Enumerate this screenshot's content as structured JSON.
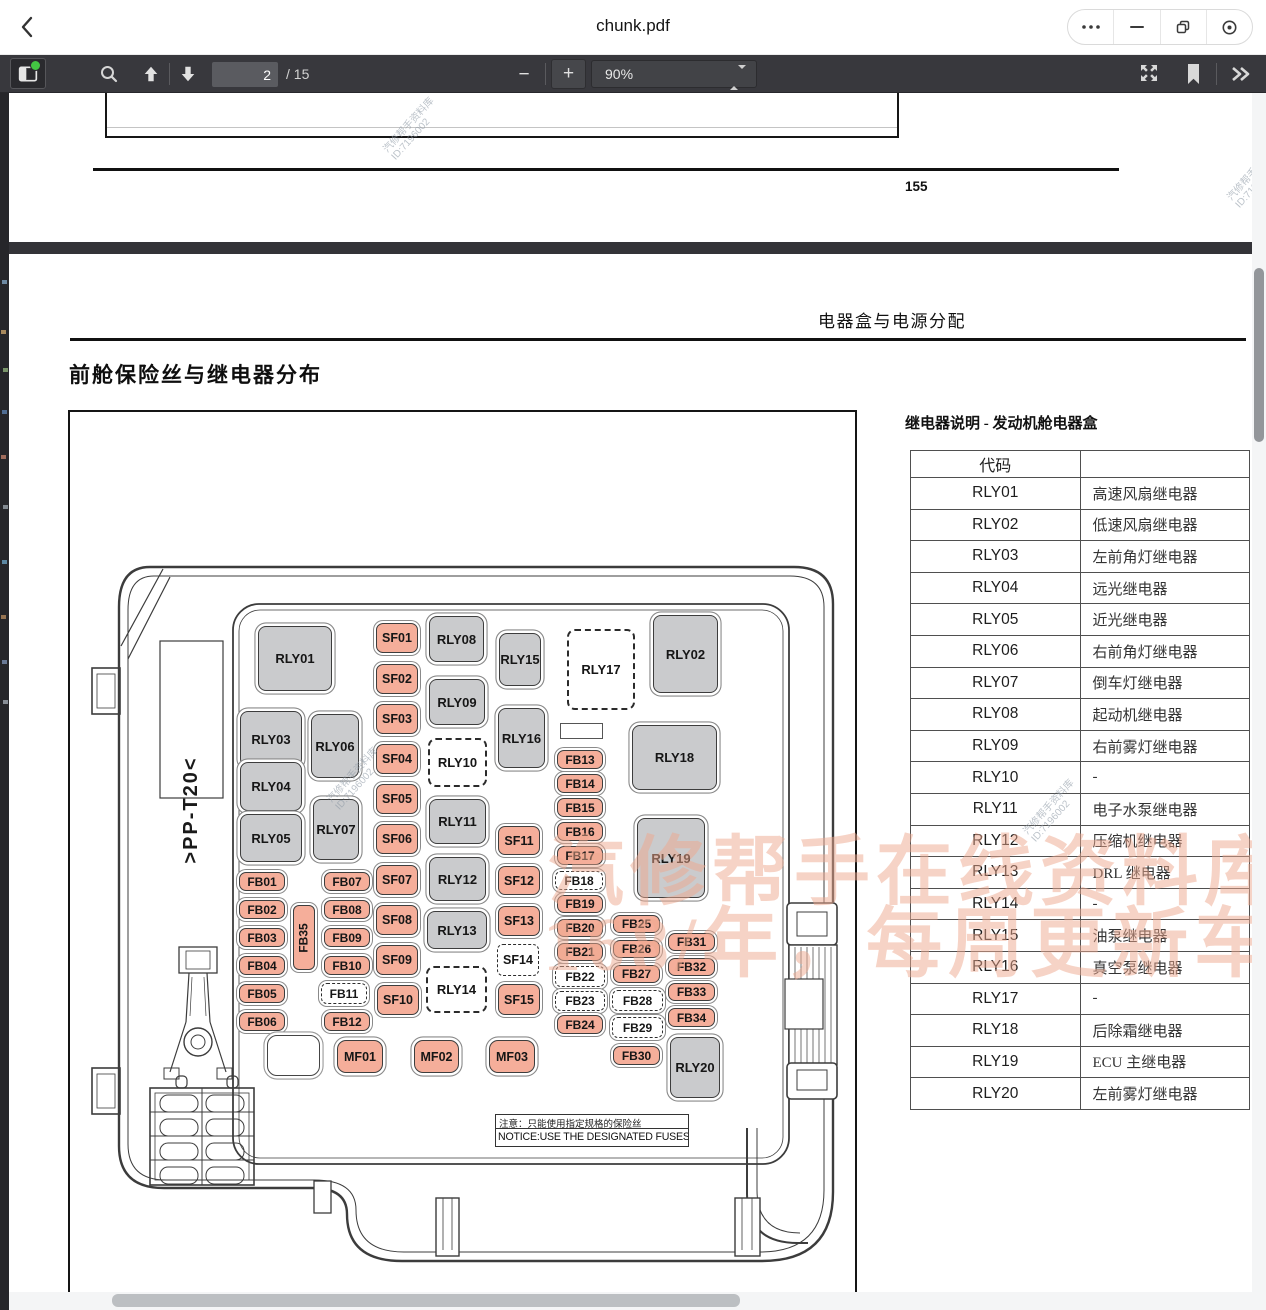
{
  "titlebar": {
    "title": "chunk.pdf",
    "icons": [
      "back-chevron",
      "more-dots",
      "minimize",
      "restore",
      "focus-circle"
    ]
  },
  "toolbar": {
    "page_value": "2",
    "page_total": "/ 15",
    "zoom_value": "90%",
    "icons": [
      "sidebar-toggle",
      "search",
      "page-up",
      "page-down",
      "zoom-out",
      "zoom-in",
      "presentation",
      "bookmark",
      "more-chevrons"
    ]
  },
  "page1": {
    "page_number": "155"
  },
  "page2": {
    "corner_header": "电器盒与电源分配",
    "section_title": "前舱保险丝与继电器分布",
    "side_label": ">PP-T20<",
    "notice_cn": "注意：只能使用指定规格的保险丝",
    "notice_en": "NOTICE:USE THE DESIGNATED FUSES ONLY!"
  },
  "watermarks": {
    "stamp_line1": "汽修帮手资料库",
    "stamp_line2": "ID:7196002",
    "banner_line1": "汽修帮手在线资料库",
    "banner_line2": "168/年，每周更新车",
    "banner_color": "#efa98f"
  },
  "relay_table": {
    "title": "继电器说明 - 发动机舱电器盒",
    "col1_header": "代码",
    "col2_header": "",
    "rows": [
      {
        "code": "RLY01",
        "desc": "高速风扇继电器"
      },
      {
        "code": "RLY02",
        "desc": "低速风扇继电器"
      },
      {
        "code": "RLY03",
        "desc": "左前角灯继电器"
      },
      {
        "code": "RLY04",
        "desc": "远光继电器"
      },
      {
        "code": "RLY05",
        "desc": "近光继电器"
      },
      {
        "code": "RLY06",
        "desc": "右前角灯继电器"
      },
      {
        "code": "RLY07",
        "desc": "倒车灯继电器"
      },
      {
        "code": "RLY08",
        "desc": "起动机继电器"
      },
      {
        "code": "RLY09",
        "desc": "右前雾灯继电器"
      },
      {
        "code": "RLY10",
        "desc": "-"
      },
      {
        "code": "RLY11",
        "desc": "电子水泵继电器"
      },
      {
        "code": "RLY12",
        "desc": "压缩机继电器"
      },
      {
        "code": "RLY13",
        "desc": "DRL 继电器"
      },
      {
        "code": "RLY14",
        "desc": "-"
      },
      {
        "code": "RLY15",
        "desc": "油泵继电器"
      },
      {
        "code": "RLY16",
        "desc": "真空泵继电器"
      },
      {
        "code": "RLY17",
        "desc": "-"
      },
      {
        "code": "RLY18",
        "desc": "后除霜继电器"
      },
      {
        "code": "RLY19",
        "desc": "ECU 主继电器"
      },
      {
        "code": "RLY20",
        "desc": "左前雾灯继电器"
      }
    ]
  },
  "diagram": {
    "colors": {
      "relay_fill": "#cacbcd",
      "fuse_fill": "#f5ae9a",
      "outline": "#3d3d3d"
    },
    "nodes": [
      {
        "id": "RLY01",
        "x": 258,
        "y": 626,
        "w": 74,
        "h": 65,
        "t": "relay"
      },
      {
        "id": "RLY02",
        "x": 653,
        "y": 615,
        "w": 65,
        "h": 78,
        "t": "relay"
      },
      {
        "id": "RLY03",
        "x": 240,
        "y": 711,
        "w": 62,
        "h": 56,
        "t": "relay"
      },
      {
        "id": "RLY04",
        "x": 240,
        "y": 762,
        "w": 62,
        "h": 49,
        "t": "relay"
      },
      {
        "id": "RLY05",
        "x": 240,
        "y": 814,
        "w": 62,
        "h": 48,
        "t": "relay"
      },
      {
        "id": "RLY06",
        "x": 311,
        "y": 714,
        "w": 48,
        "h": 64,
        "t": "relay"
      },
      {
        "id": "RLY07",
        "x": 313,
        "y": 799,
        "w": 46,
        "h": 61,
        "t": "relay"
      },
      {
        "id": "RLY08",
        "x": 429,
        "y": 616,
        "w": 55,
        "h": 46,
        "t": "relay"
      },
      {
        "id": "RLY09",
        "x": 429,
        "y": 679,
        "w": 56,
        "h": 46,
        "t": "relay"
      },
      {
        "id": "RLY11",
        "x": 429,
        "y": 799,
        "w": 57,
        "h": 45,
        "t": "relay"
      },
      {
        "id": "RLY12",
        "x": 429,
        "y": 857,
        "w": 57,
        "h": 44,
        "t": "relay"
      },
      {
        "id": "RLY13",
        "x": 427,
        "y": 911,
        "w": 60,
        "h": 38,
        "t": "relay"
      },
      {
        "id": "RLY15",
        "x": 499,
        "y": 633,
        "w": 42,
        "h": 53,
        "t": "relay"
      },
      {
        "id": "RLY16",
        "x": 498,
        "y": 708,
        "w": 47,
        "h": 60,
        "t": "relay"
      },
      {
        "id": "RLY18",
        "x": 632,
        "y": 725,
        "w": 85,
        "h": 65,
        "t": "relay"
      },
      {
        "id": "RLY19",
        "x": 637,
        "y": 818,
        "w": 68,
        "h": 80,
        "t": "relay"
      },
      {
        "id": "RLY20",
        "x": 670,
        "y": 1037,
        "w": 50,
        "h": 61,
        "t": "relay"
      },
      {
        "id": "RLY10",
        "x": 428,
        "y": 738,
        "w": 59,
        "h": 49,
        "t": "dash-lg"
      },
      {
        "id": "RLY14",
        "x": 426,
        "y": 966,
        "w": 61,
        "h": 47,
        "t": "dash-lg"
      },
      {
        "id": "RLY17",
        "x": 567,
        "y": 629,
        "w": 68,
        "h": 81,
        "t": "dash-lg"
      },
      {
        "id": "SF14",
        "x": 497,
        "y": 944,
        "w": 42,
        "h": 32,
        "t": "dash-sf"
      },
      {
        "id": "FB11",
        "x": 321,
        "y": 983,
        "w": 46,
        "h": 21,
        "t": "dash-fb"
      },
      {
        "id": "FB18",
        "x": 555,
        "y": 871,
        "w": 48,
        "h": 19,
        "t": "dash-fb"
      },
      {
        "id": "FB22",
        "x": 555,
        "y": 966,
        "w": 50,
        "h": 21,
        "t": "dash-fb"
      },
      {
        "id": "FB23",
        "x": 555,
        "y": 991,
        "w": 50,
        "h": 20,
        "t": "dash-fb"
      },
      {
        "id": "FB28",
        "x": 612,
        "y": 990,
        "w": 51,
        "h": 21,
        "t": "dash-fb"
      },
      {
        "id": "FB29",
        "x": 612,
        "y": 1017,
        "w": 51,
        "h": 21,
        "t": "dash-fb"
      },
      {
        "id": "SF01",
        "x": 376,
        "y": 623,
        "w": 42,
        "h": 30,
        "t": "fuse sf"
      },
      {
        "id": "SF02",
        "x": 376,
        "y": 664,
        "w": 42,
        "h": 30,
        "t": "fuse sf"
      },
      {
        "id": "SF03",
        "x": 376,
        "y": 704,
        "w": 42,
        "h": 30,
        "t": "fuse sf"
      },
      {
        "id": "SF04",
        "x": 376,
        "y": 744,
        "w": 42,
        "h": 30,
        "t": "fuse sf"
      },
      {
        "id": "SF05",
        "x": 376,
        "y": 784,
        "w": 42,
        "h": 30,
        "t": "fuse sf"
      },
      {
        "id": "SF06",
        "x": 376,
        "y": 824,
        "w": 42,
        "h": 30,
        "t": "fuse sf"
      },
      {
        "id": "SF07",
        "x": 376,
        "y": 865,
        "w": 42,
        "h": 30,
        "t": "fuse sf"
      },
      {
        "id": "SF08",
        "x": 376,
        "y": 905,
        "w": 42,
        "h": 30,
        "t": "fuse sf"
      },
      {
        "id": "SF09",
        "x": 376,
        "y": 945,
        "w": 42,
        "h": 30,
        "t": "fuse sf"
      },
      {
        "id": "SF10",
        "x": 377,
        "y": 985,
        "w": 42,
        "h": 30,
        "t": "fuse sf"
      },
      {
        "id": "SF11",
        "x": 498,
        "y": 826,
        "w": 42,
        "h": 29,
        "t": "fuse sf"
      },
      {
        "id": "SF12",
        "x": 498,
        "y": 866,
        "w": 42,
        "h": 29,
        "t": "fuse sf"
      },
      {
        "id": "SF13",
        "x": 498,
        "y": 906,
        "w": 42,
        "h": 30,
        "t": "fuse sf"
      },
      {
        "id": "SF15",
        "x": 498,
        "y": 984,
        "w": 42,
        "h": 31,
        "t": "fuse sf"
      },
      {
        "id": "FB01",
        "x": 239,
        "y": 872,
        "w": 46,
        "h": 19,
        "t": "fuse"
      },
      {
        "id": "FB02",
        "x": 239,
        "y": 900,
        "w": 46,
        "h": 19,
        "t": "fuse"
      },
      {
        "id": "FB03",
        "x": 239,
        "y": 928,
        "w": 46,
        "h": 19,
        "t": "fuse"
      },
      {
        "id": "FB04",
        "x": 239,
        "y": 956,
        "w": 46,
        "h": 19,
        "t": "fuse"
      },
      {
        "id": "FB05",
        "x": 239,
        "y": 984,
        "w": 46,
        "h": 19,
        "t": "fuse"
      },
      {
        "id": "FB06",
        "x": 239,
        "y": 1012,
        "w": 46,
        "h": 19,
        "t": "fuse"
      },
      {
        "id": "FB07",
        "x": 324,
        "y": 872,
        "w": 46,
        "h": 19,
        "t": "fuse"
      },
      {
        "id": "FB08",
        "x": 324,
        "y": 900,
        "w": 46,
        "h": 19,
        "t": "fuse"
      },
      {
        "id": "FB09",
        "x": 324,
        "y": 928,
        "w": 46,
        "h": 19,
        "t": "fuse"
      },
      {
        "id": "FB10",
        "x": 324,
        "y": 956,
        "w": 46,
        "h": 19,
        "t": "fuse"
      },
      {
        "id": "FB12",
        "x": 324,
        "y": 1012,
        "w": 46,
        "h": 19,
        "t": "fuse"
      },
      {
        "id": "FB35",
        "x": 293,
        "y": 905,
        "w": 22,
        "h": 65,
        "t": "fusev"
      },
      {
        "id": "FB13",
        "x": 557,
        "y": 750,
        "w": 46,
        "h": 19,
        "t": "fuse"
      },
      {
        "id": "FB14",
        "x": 557,
        "y": 774,
        "w": 46,
        "h": 19,
        "t": "fuse"
      },
      {
        "id": "FB15",
        "x": 557,
        "y": 798,
        "w": 46,
        "h": 19,
        "t": "fuse"
      },
      {
        "id": "FB16",
        "x": 557,
        "y": 822,
        "w": 46,
        "h": 19,
        "t": "fuse"
      },
      {
        "id": "FB17",
        "x": 557,
        "y": 846,
        "w": 46,
        "h": 19,
        "t": "fuse"
      },
      {
        "id": "FB19",
        "x": 557,
        "y": 895,
        "w": 46,
        "h": 18,
        "t": "fuse"
      },
      {
        "id": "FB20",
        "x": 557,
        "y": 919,
        "w": 46,
        "h": 18,
        "t": "fuse"
      },
      {
        "id": "FB21",
        "x": 557,
        "y": 943,
        "w": 46,
        "h": 18,
        "t": "fuse"
      },
      {
        "id": "FB24",
        "x": 557,
        "y": 1015,
        "w": 46,
        "h": 19,
        "t": "fuse"
      },
      {
        "id": "FB25",
        "x": 613,
        "y": 915,
        "w": 47,
        "h": 18,
        "t": "fuse"
      },
      {
        "id": "FB26",
        "x": 613,
        "y": 940,
        "w": 47,
        "h": 18,
        "t": "fuse"
      },
      {
        "id": "FB27",
        "x": 613,
        "y": 965,
        "w": 47,
        "h": 18,
        "t": "fuse"
      },
      {
        "id": "FB30",
        "x": 613,
        "y": 1046,
        "w": 47,
        "h": 19,
        "t": "fuse"
      },
      {
        "id": "FB31",
        "x": 668,
        "y": 933,
        "w": 47,
        "h": 18,
        "t": "fuse"
      },
      {
        "id": "FB32",
        "x": 668,
        "y": 958,
        "w": 47,
        "h": 18,
        "t": "fuse"
      },
      {
        "id": "FB33",
        "x": 668,
        "y": 983,
        "w": 47,
        "h": 18,
        "t": "fuse"
      },
      {
        "id": "FB34",
        "x": 668,
        "y": 1008,
        "w": 47,
        "h": 19,
        "t": "fuse"
      },
      {
        "id": "MF01",
        "x": 337,
        "y": 1040,
        "w": 46,
        "h": 33,
        "t": "mf"
      },
      {
        "id": "MF02",
        "x": 414,
        "y": 1040,
        "w": 45,
        "h": 33,
        "t": "mf"
      },
      {
        "id": "MF03",
        "x": 489,
        "y": 1040,
        "w": 46,
        "h": 33,
        "t": "mf"
      },
      {
        "id": "blank-slot",
        "x": 560,
        "y": 723,
        "w": 43,
        "h": 16,
        "t": "blank",
        "label": ""
      },
      {
        "id": "blank-round",
        "x": 267,
        "y": 1035,
        "w": 53,
        "h": 41,
        "t": "blankr",
        "label": ""
      }
    ]
  }
}
